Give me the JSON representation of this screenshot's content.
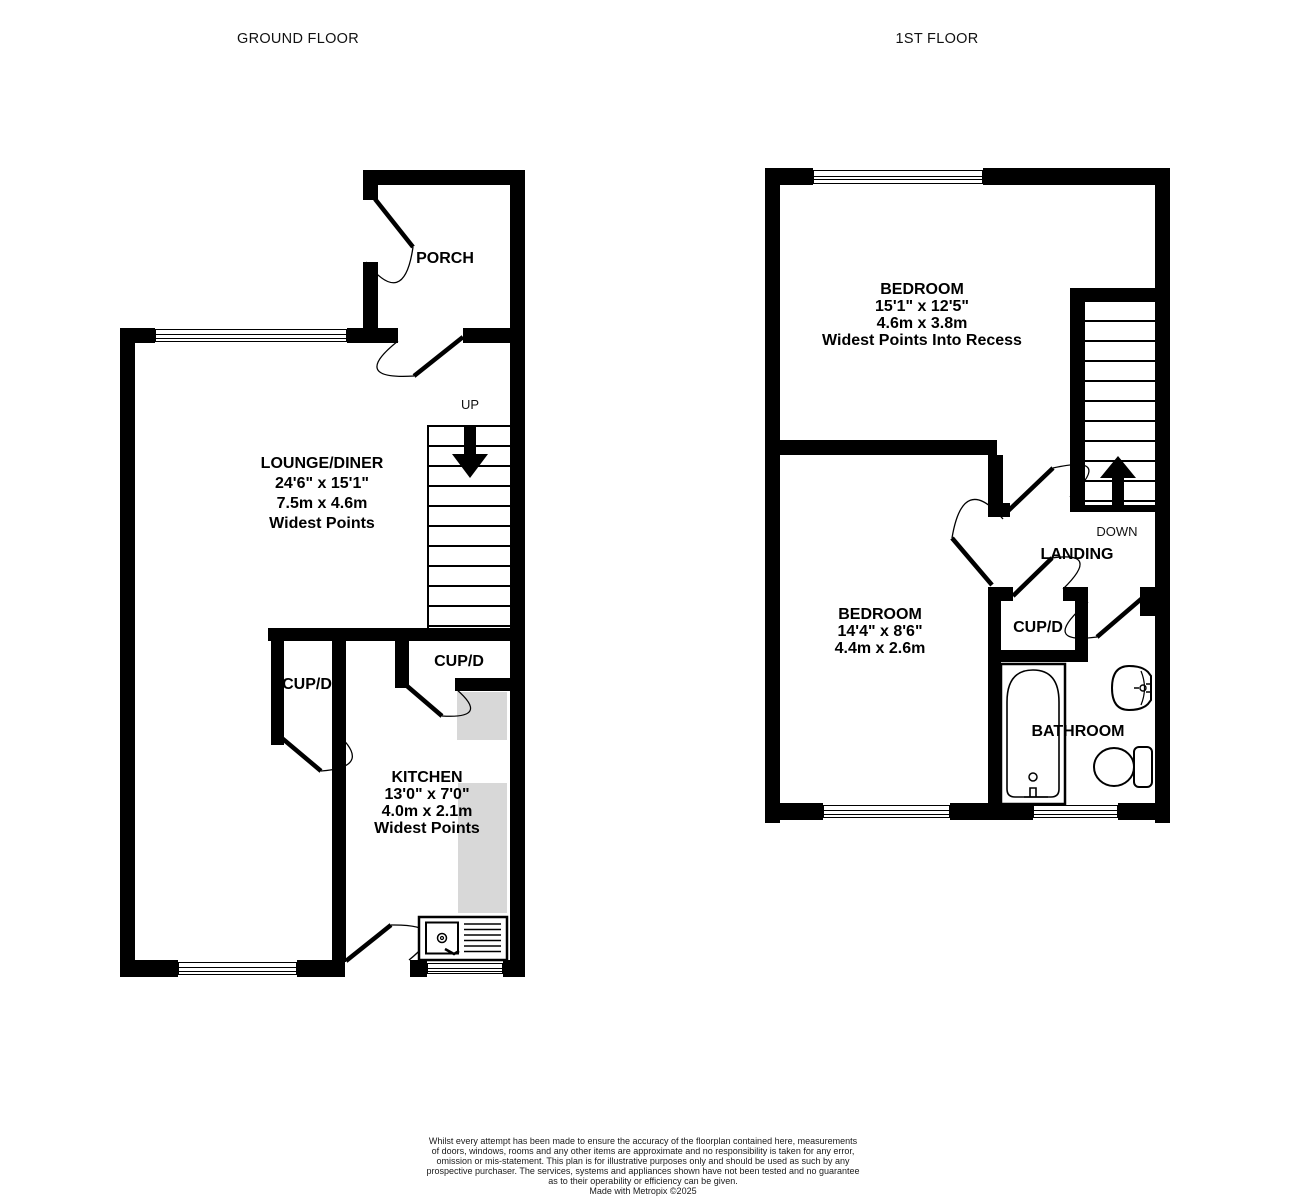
{
  "titles": {
    "ground": "GROUND FLOOR",
    "first": "1ST FLOOR"
  },
  "ground": {
    "porch": "PORCH",
    "up": "UP",
    "lounge": {
      "name": "LOUNGE/DINER",
      "imperial": "24'6\"  x 15'1\"",
      "metric": "7.5m  x 4.6m",
      "note": "Widest Points"
    },
    "cupd_hall": "CUP/D",
    "cupd_kitchen": "CUP/D",
    "kitchen": {
      "name": "KITCHEN",
      "imperial": "13'0\"  x 7'0\"",
      "metric": "4.0m  x 2.1m",
      "note": "Widest Points"
    }
  },
  "first": {
    "down": "DOWN",
    "landing": "LANDING",
    "bedroom1": {
      "name": "BEDROOM",
      "imperial": "15'1\"  x 12'5\"",
      "metric": "4.6m  x 3.8m",
      "note": "Widest Points Into Recess"
    },
    "bedroom2": {
      "name": "BEDROOM",
      "imperial": "14'4\"  x 8'6\"",
      "metric": "4.4m  x 2.6m"
    },
    "cupd": "CUP/D",
    "bathroom": "BATHROOM"
  },
  "footer": {
    "l1": "Whilst every attempt has been made to ensure the accuracy of the floorplan contained here, measurements",
    "l2": "of doors, windows, rooms and any other items are approximate and no responsibility is taken for any error,",
    "l3": "omission or mis-statement. This plan is for illustrative purposes only and should be used as such by any",
    "l4": "prospective purchaser. The services, systems and appliances shown have not been tested and no guarantee",
    "l5": "as to their operability or efficiency can be given.",
    "credit": "Made with Metropix ©2025"
  },
  "colors": {
    "wall": "#000000",
    "counter": "#d8d8d8"
  }
}
